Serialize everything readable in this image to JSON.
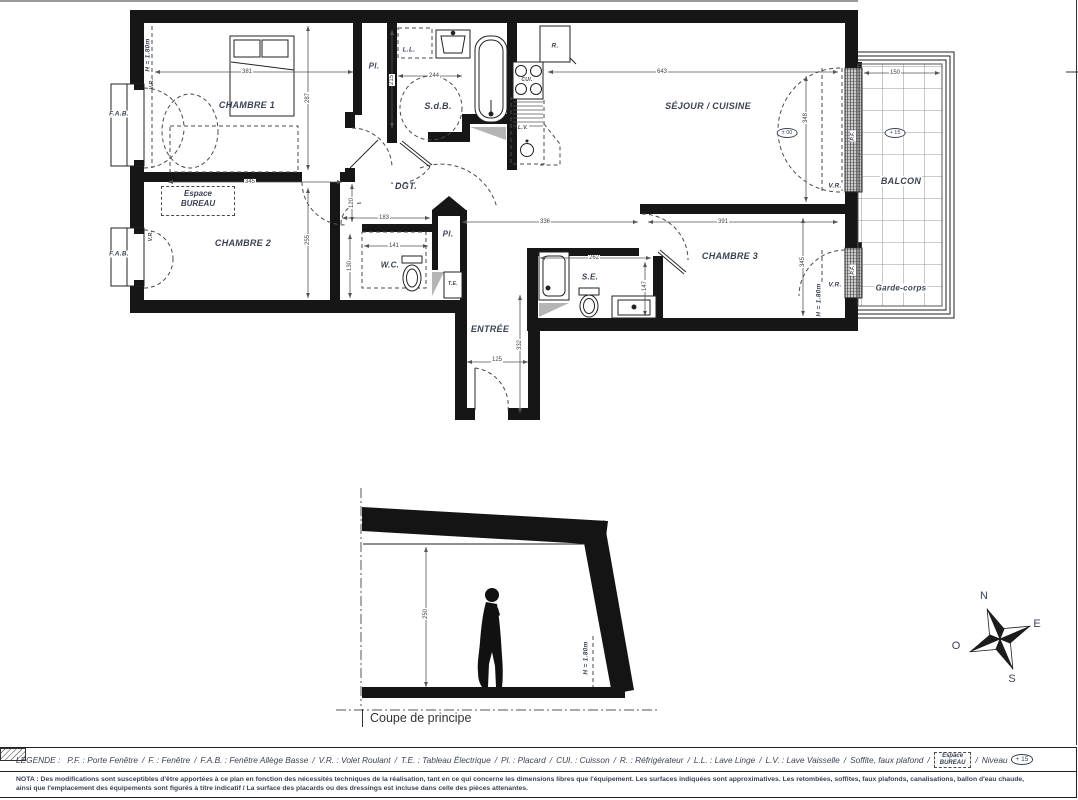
{
  "plan": {
    "rooms": {
      "chambre1": "CHAMBRE 1",
      "chambre2": "CHAMBRE 2",
      "chambre3": "CHAMBRE 3",
      "sejour": "SÉJOUR / CUISINE",
      "sdb": "S.d.B.",
      "wc": "W.C.",
      "se": "S.E.",
      "dgt": "DGT.",
      "entree": "ENTRÉE",
      "balcon": "BALCON",
      "garde_corps": "Garde-corps",
      "espace_line1": "Espace",
      "espace_line2": "BUREAU"
    },
    "fixtures": {
      "placard": "Pl.",
      "lave_linge": "L.L.",
      "refrigerateur": "R.",
      "cuisson": "CUI.",
      "lave_vaisselle": "L.V.",
      "tableau_electrique": "T.E."
    },
    "windows": {
      "fab": "F.A.B.",
      "vr": "V.R.",
      "pf": "P.F."
    },
    "heights": {
      "h180": "H = 1.80m"
    },
    "levels": {
      "zero": "± 00",
      "plus15": "+ 15"
    },
    "dims": {
      "chambre1_w": "381",
      "chambre1_h": "287",
      "bureau_w": "345",
      "sdb_w": "244",
      "sdb_h": "215",
      "sejour_w": "643",
      "sejour_h": "348",
      "balcon_w": "150",
      "hall_w": "336",
      "wc_zone": "183",
      "chambre3_w": "391",
      "chambre3_h": "345",
      "chambre2_h": "255",
      "dgt_h": "120",
      "wc_h": "130",
      "wc_w": "141",
      "se_w": "262",
      "se_h": "147",
      "entree_h": "332",
      "porte_w": "125"
    }
  },
  "section": {
    "title": "Coupe de principe",
    "height_dim": "250",
    "h180": "H = 1.80m"
  },
  "compass": {
    "north": "N",
    "east": "E",
    "south": "S",
    "west": "O"
  },
  "legend": {
    "title": "LÉGENDE :",
    "sep": "/",
    "items": [
      "P.F. : Porte Fenêtre",
      "F. : Fenêtre",
      "F.A.B. : Fenêtre Allège Basse",
      "V.R. : Volet Roulant",
      "T.E. : Tableau Électrique",
      "Pl. : Placard",
      "CUI. : Cuisson",
      "R. : Réfrigérateur",
      "L.L. : Lave Linge",
      "L.V. : Lave Vaisselle",
      "Soffite, faux plafond"
    ],
    "espace_line1": "Espace",
    "espace_line2": "BUREAU",
    "niveau": "Niveau",
    "niveau_value": "+ 15"
  },
  "nota": {
    "title": "NOTA :",
    "line1": "Des modifications sont susceptibles d'être apportées à ce plan en fonction des nécessités techniques de la réalisation, tant en ce qui concerne les dimensions libres que l'équipement. Les surfaces indiquées sont approximatives. Les retombées, soffites, faux plafonds, canalisations, ballon d'eau chaude,",
    "line2": "ainsi que l'emplacement des équipements sont figurés à titre indicatif / La surface des placards ou des dressings est incluse dans celle des pièces attenantes."
  }
}
